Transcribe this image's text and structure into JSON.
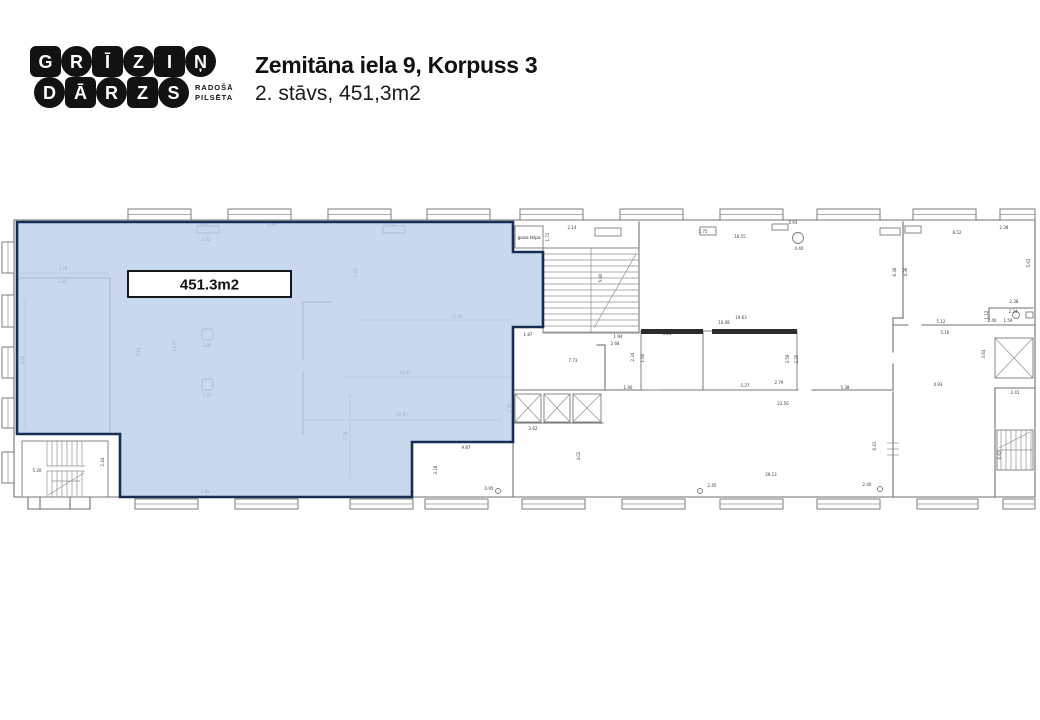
{
  "header": {
    "logo": {
      "rows": [
        [
          {
            "c": "G",
            "s": "sq"
          },
          {
            "c": "R",
            "s": "ci"
          },
          {
            "c": "Ī",
            "s": "sq"
          },
          {
            "c": "Z",
            "s": "ci"
          },
          {
            "c": "I",
            "s": "sq"
          },
          {
            "c": "Ņ",
            "s": "ci"
          }
        ],
        [
          {
            "c": "D",
            "s": "ci"
          },
          {
            "c": "Ā",
            "s": "sq"
          },
          {
            "c": "R",
            "s": "ci"
          },
          {
            "c": "Z",
            "s": "sq"
          },
          {
            "c": "S",
            "s": "ci"
          }
        ]
      ],
      "tagline": [
        "RADOŠĀ",
        "PILSĒTA"
      ]
    },
    "title": "Zemitāna iela 9, Korpuss 3",
    "subtitle": "2. stāvs, 451,3m2"
  },
  "floorplan": {
    "colors": {
      "highlight_fill": "#b9cde8",
      "highlight_border": "#152f52",
      "wall": "#6f6f6f"
    },
    "area_label": "451.3m2",
    "air_space_label": "gaisa telpa",
    "area_box": [
      128,
      271,
      163,
      26
    ],
    "air_box": [
      515,
      226,
      28,
      22
    ],
    "highlight_points": "17,222 513,222 513,252 543,252 543,327 513,327 513,442 412,442 412,497 120,497 120,434 17,434",
    "walls": [
      [
        14,
        220,
        1035,
        220
      ],
      [
        14,
        220,
        14,
        497
      ],
      [
        1035,
        220,
        1035,
        497
      ],
      [
        14,
        497,
        1035,
        497
      ],
      [
        17,
        278,
        110,
        278
      ],
      [
        110,
        278,
        110,
        434
      ],
      [
        303,
        302,
        303,
        360
      ],
      [
        303,
        372,
        303,
        434
      ],
      [
        303,
        302,
        332,
        302
      ],
      [
        639,
        222,
        639,
        332
      ],
      [
        597,
        345,
        605,
        345
      ],
      [
        605,
        345,
        605,
        390
      ],
      [
        513,
        390,
        648,
        390
      ],
      [
        660,
        390,
        798,
        390
      ],
      [
        812,
        390,
        893,
        390
      ],
      [
        513,
        423,
        603,
        423
      ],
      [
        513,
        442,
        513,
        497
      ],
      [
        903,
        222,
        903,
        318
      ],
      [
        893,
        318,
        903,
        318
      ],
      [
        893,
        318,
        893,
        352
      ],
      [
        893,
        364,
        893,
        390
      ],
      [
        893,
        392,
        893,
        497
      ],
      [
        893,
        325,
        908,
        325
      ],
      [
        922,
        325,
        987,
        325
      ],
      [
        987,
        325,
        1035,
        325
      ],
      [
        989,
        308,
        1033,
        308
      ],
      [
        989,
        308,
        989,
        320
      ],
      [
        995,
        388,
        1035,
        388
      ],
      [
        995,
        388,
        995,
        497
      ],
      [
        28,
        497,
        28,
        509
      ],
      [
        90,
        497,
        90,
        509
      ],
      [
        28,
        509,
        90,
        509
      ],
      [
        40,
        497,
        40,
        509
      ],
      [
        70,
        497,
        70,
        509
      ]
    ],
    "thin_lines": [
      [
        887,
        443,
        899,
        443
      ],
      [
        887,
        449,
        899,
        449
      ],
      [
        887,
        455,
        899,
        455
      ]
    ],
    "dim_lines": [
      [
        360,
        320,
        512,
        320
      ],
      [
        345,
        377,
        513,
        377
      ],
      [
        303,
        420,
        500,
        420
      ],
      [
        350,
        395,
        350,
        478
      ],
      [
        25,
        300,
        25,
        428
      ],
      [
        20,
        273,
        108,
        273
      ]
    ],
    "rooms": [
      [
        641,
        331,
        62,
        59
      ],
      [
        703,
        331,
        94,
        59
      ]
    ],
    "dark_bars": [
      [
        641,
        329,
        62,
        5
      ],
      [
        712,
        329,
        85,
        5
      ]
    ],
    "top_windows": {
      "y": 209,
      "h": 11,
      "items": [
        [
          128,
          63
        ],
        [
          228,
          63
        ],
        [
          328,
          63
        ],
        [
          427,
          63
        ],
        [
          520,
          63
        ],
        [
          620,
          63
        ],
        [
          720,
          63
        ],
        [
          817,
          63
        ],
        [
          913,
          63
        ],
        [
          1000,
          35
        ]
      ]
    },
    "bottom_windows": {
      "y": 499,
      "h": 10,
      "items": [
        [
          135,
          63
        ],
        [
          235,
          63
        ],
        [
          350,
          63
        ],
        [
          425,
          63
        ],
        [
          522,
          63
        ],
        [
          622,
          63
        ],
        [
          720,
          63
        ],
        [
          817,
          63
        ],
        [
          917,
          61
        ],
        [
          1003,
          32
        ]
      ]
    },
    "left_windows": {
      "x": 2,
      "w": 12,
      "items": [
        [
          242,
          31
        ],
        [
          295,
          32
        ],
        [
          347,
          31
        ],
        [
          398,
          30
        ],
        [
          452,
          31
        ]
      ]
    },
    "shafts": [
      [
        515,
        394,
        26,
        28
      ],
      [
        544,
        394,
        26,
        28
      ],
      [
        573,
        394,
        28,
        28
      ],
      [
        995,
        338,
        38,
        40
      ]
    ],
    "columns": [
      [
        202,
        329,
        11,
        11
      ],
      [
        202,
        379,
        11,
        11
      ]
    ],
    "circles": [
      [
        798,
        238,
        5.5
      ],
      [
        1016,
        315,
        3.5
      ],
      [
        498,
        491,
        2.5
      ],
      [
        700,
        491,
        2.5
      ],
      [
        880,
        489,
        2.5
      ]
    ],
    "sills": [
      [
        197,
        226,
        22,
        7
      ],
      [
        383,
        226,
        22,
        7
      ],
      [
        595,
        228,
        26,
        8
      ],
      [
        700,
        227,
        16,
        8
      ],
      [
        772,
        224,
        16,
        6
      ],
      [
        880,
        228,
        20,
        7
      ],
      [
        905,
        226,
        16,
        7
      ],
      [
        1026,
        312,
        7,
        6
      ]
    ],
    "stairs": {
      "mid": {
        "x": 543,
        "y": 248,
        "w": 96,
        "h": 85,
        "divider": 591,
        "step": 6,
        "diag": [
          594,
          328,
          636,
          254
        ]
      },
      "bottom_left": {
        "x": 22,
        "y": 441,
        "w": 86,
        "h": 56,
        "tx0": 47,
        "tx1": 85,
        "step": 5,
        "land": [
          466,
          471
        ],
        "diag": [
          48,
          495,
          84,
          473
        ],
        "arrow": [
          52,
          481,
          80,
          481
        ]
      },
      "right": {
        "x": 997,
        "y": 430,
        "w": 36,
        "h": 40,
        "divider_y": 450,
        "tx0": 1001,
        "tx1": 1031,
        "step": 5,
        "diag": [
          999,
          448,
          1030,
          432
        ]
      }
    },
    "dim_labels": [
      {
        "t": "3.28",
        "x": 63,
        "y": 270
      },
      {
        "t": "3.25",
        "x": 62,
        "y": 283
      },
      {
        "t": "4.28",
        "x": 24,
        "y": 360,
        "r": 1
      },
      {
        "t": "2.18",
        "x": 140,
        "y": 352,
        "r": 1
      },
      {
        "t": "14.77",
        "x": 176,
        "y": 346,
        "r": 1
      },
      {
        "t": "7.44",
        "x": 357,
        "y": 273,
        "r": 1
      },
      {
        "t": "12.83",
        "x": 457,
        "y": 318
      },
      {
        "t": "1.08",
        "x": 207,
        "y": 347
      },
      {
        "t": "1.07",
        "x": 207,
        "y": 397
      },
      {
        "t": "12.47",
        "x": 405,
        "y": 374
      },
      {
        "t": "12.97",
        "x": 402,
        "y": 416
      },
      {
        "t": "7.19",
        "x": 347,
        "y": 436,
        "r": 1
      },
      {
        "t": "2.72",
        "x": 511,
        "y": 408,
        "r": 1
      },
      {
        "t": "3.98",
        "x": 205,
        "y": 493
      },
      {
        "t": "5.20",
        "x": 37,
        "y": 472
      },
      {
        "t": "2.44",
        "x": 104,
        "y": 462,
        "r": 1
      },
      {
        "t": "0.94",
        "x": 204,
        "y": 225
      },
      {
        "t": "2.02",
        "x": 206,
        "y": 241
      },
      {
        "t": "0.98",
        "x": 272,
        "y": 226
      },
      {
        "t": "0.94",
        "x": 390,
        "y": 225
      },
      {
        "t": "2.14",
        "x": 572,
        "y": 229
      },
      {
        "t": "1.72",
        "x": 549,
        "y": 237,
        "r": 1
      },
      {
        "t": "16.55",
        "x": 740,
        "y": 238
      },
      {
        "t": "0.64",
        "x": 793,
        "y": 224
      },
      {
        "t": "0.40",
        "x": 799,
        "y": 250
      },
      {
        "t": "1.75",
        "x": 703,
        "y": 233
      },
      {
        "t": "8.52",
        "x": 957,
        "y": 234
      },
      {
        "t": "2.38",
        "x": 1004,
        "y": 229
      },
      {
        "t": "5.63",
        "x": 1030,
        "y": 263,
        "r": 1
      },
      {
        "t": "1.87",
        "x": 528,
        "y": 336
      },
      {
        "t": "7.73",
        "x": 573,
        "y": 362
      },
      {
        "t": "5.90",
        "x": 602,
        "y": 278,
        "r": 1
      },
      {
        "t": "6.36",
        "x": 896,
        "y": 272,
        "r": 1
      },
      {
        "t": "4.36",
        "x": 907,
        "y": 272,
        "r": 1
      },
      {
        "t": "19.63",
        "x": 741,
        "y": 319
      },
      {
        "t": "10.08",
        "x": 724,
        "y": 324
      },
      {
        "t": "3.26",
        "x": 667,
        "y": 335
      },
      {
        "t": "1.94",
        "x": 618,
        "y": 338
      },
      {
        "t": "2.68",
        "x": 615,
        "y": 345
      },
      {
        "t": "2.34",
        "x": 634,
        "y": 357,
        "r": 1
      },
      {
        "t": "1.60",
        "x": 644,
        "y": 358,
        "r": 1
      },
      {
        "t": "3.59",
        "x": 789,
        "y": 359,
        "r": 1
      },
      {
        "t": "2.25",
        "x": 798,
        "y": 359,
        "r": 1
      },
      {
        "t": "5.27",
        "x": 745,
        "y": 387
      },
      {
        "t": "5.38",
        "x": 845,
        "y": 389
      },
      {
        "t": "1.90",
        "x": 628,
        "y": 389
      },
      {
        "t": "2.79",
        "x": 779,
        "y": 384
      },
      {
        "t": "23.56",
        "x": 783,
        "y": 405
      },
      {
        "t": "29.13",
        "x": 771,
        "y": 476
      },
      {
        "t": "4.93",
        "x": 938,
        "y": 386
      },
      {
        "t": "2.41",
        "x": 1015,
        "y": 394
      },
      {
        "t": "6.62",
        "x": 1001,
        "y": 455,
        "r": 1
      },
      {
        "t": "6.41",
        "x": 876,
        "y": 446,
        "r": 1
      },
      {
        "t": "3.64",
        "x": 985,
        "y": 354,
        "r": 1
      },
      {
        "t": "5.12",
        "x": 941,
        "y": 323
      },
      {
        "t": "5.16",
        "x": 945,
        "y": 334
      },
      {
        "t": "2.38",
        "x": 1014,
        "y": 303
      },
      {
        "t": "2.24",
        "x": 1013,
        "y": 313
      },
      {
        "t": "1.59",
        "x": 1008,
        "y": 322
      },
      {
        "t": "2.46",
        "x": 992,
        "y": 322
      },
      {
        "t": "1.12",
        "x": 988,
        "y": 315,
        "r": 1
      },
      {
        "t": "3.62",
        "x": 533,
        "y": 430
      },
      {
        "t": "4.02",
        "x": 580,
        "y": 456,
        "r": 1
      },
      {
        "t": "9.87",
        "x": 466,
        "y": 449
      },
      {
        "t": "3.18",
        "x": 437,
        "y": 470,
        "r": 1
      },
      {
        "t": "0.95",
        "x": 489,
        "y": 490
      },
      {
        "t": "2.45",
        "x": 712,
        "y": 487
      },
      {
        "t": "2.40",
        "x": 867,
        "y": 486
      }
    ]
  }
}
